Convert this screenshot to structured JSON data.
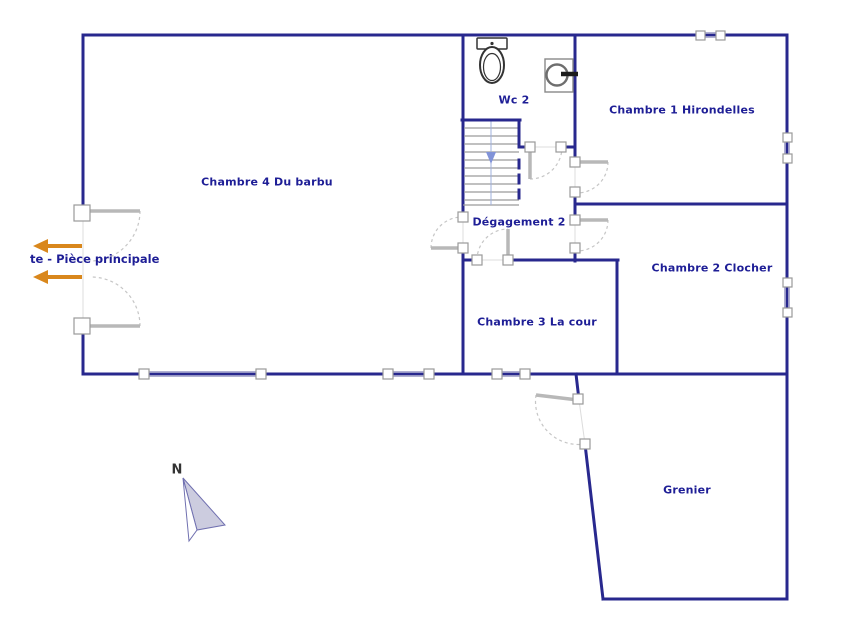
{
  "rooms": {
    "chambre4": "Chambre 4 Du barbu",
    "wc2": "Wc 2",
    "chambre1": "Chambre 1 Hirondelles",
    "degagement2": "Dégagement 2",
    "chambre2": "Chambre 2 Clocher",
    "chambre3": "Chambre 3 La cour",
    "grenier": "Grenier"
  },
  "annotations": {
    "exit_label": "te - Pièce principale",
    "compass_label": "N"
  },
  "icons": {
    "toilet": "toilet-icon",
    "washing_machine": "washing-machine-icon",
    "stairs": "stairs-icon",
    "compass": "north-arrow-icon",
    "exit_arrows": "exit-arrow-icon"
  },
  "colors": {
    "wall": "#28288e",
    "label_text": "#1e1e96",
    "accent_orange": "#d9871c",
    "door_gray": "#b8b8b8",
    "window_gray": "#a6a6cc",
    "stairs_arrow": "#8193d8",
    "compass_fill": "#ccccdf"
  }
}
